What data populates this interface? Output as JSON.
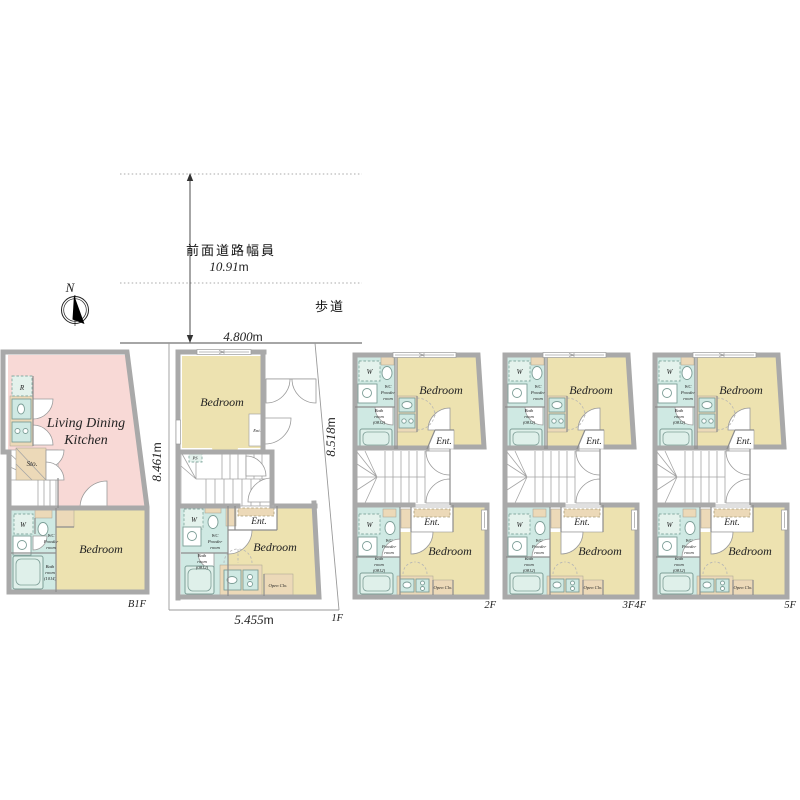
{
  "palette": {
    "ldk_pink": "#f8d9d6",
    "bedroom_beige": "#ede2b0",
    "sanitary_teal": "#cfe9e3",
    "counter_tan": "#ecd9b8",
    "wall_gray": "#a9a9a9"
  },
  "site": {
    "north": "N",
    "road_label": "前面道路幅員",
    "road_width": "10.91",
    "sidewalk": "歩道",
    "unit": "m"
  },
  "dims": {
    "frontage": "4.800",
    "left": "8.461",
    "right": "8.518",
    "bottom": "5.455",
    "unit": "m"
  },
  "b1f": {
    "label": "B1F",
    "ldk": [
      "Living Dining",
      "Kitchen"
    ],
    "bedroom": "Bedroom",
    "storage": "Sto.",
    "fridge": "R",
    "washer": "W",
    "wc": [
      "WC",
      "Powder",
      "room"
    ],
    "bath": [
      "Bath",
      "room",
      "(1014)"
    ]
  },
  "f1": {
    "label": "1F",
    "bedroom_upper": "Bedroom",
    "ent_upper": "Ent.",
    "pipe_space": "PS",
    "bedroom": "Bedroom",
    "ent": "Ent.",
    "washer": "W",
    "wc": [
      "WC",
      "Powder",
      "room"
    ],
    "bath": [
      "Bath",
      "room",
      "(0812)"
    ],
    "open_closet": "Open Clo."
  },
  "upper": {
    "bedroom_upper": "Bedroom",
    "ent_upper": "Ent.",
    "bedroom": "Bedroom",
    "ent": "Ent.",
    "washer": "W",
    "wc": [
      "WC",
      "Powder",
      "room"
    ],
    "bath": [
      "Bath",
      "room",
      "(0812)"
    ],
    "open_closet": "Open Clo."
  },
  "floors": {
    "f2": {
      "label": "2F"
    },
    "f3f4": {
      "label": "3F4F"
    },
    "f5": {
      "label": "5F"
    }
  }
}
